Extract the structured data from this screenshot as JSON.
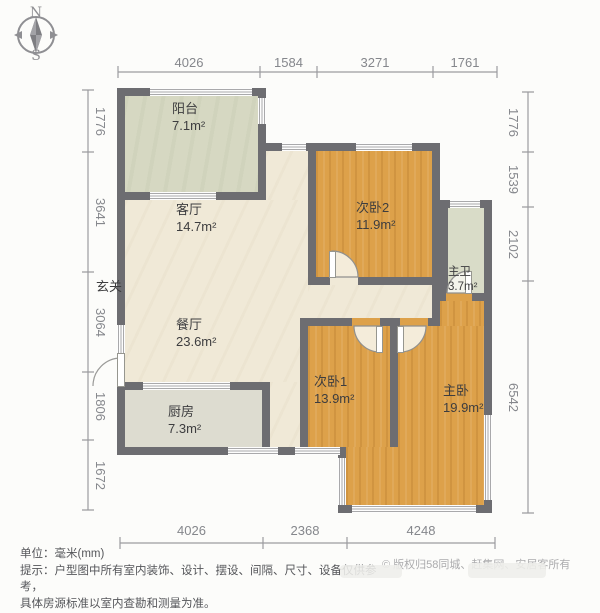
{
  "compass": {
    "north": "N",
    "south": "S"
  },
  "rooms": [
    {
      "id": "balcony",
      "name": "阳台",
      "area": "7.1m²"
    },
    {
      "id": "living",
      "name": "客厅",
      "area": "14.7m²"
    },
    {
      "id": "dining",
      "name": "餐厅",
      "area": "23.6m²"
    },
    {
      "id": "kitchen",
      "name": "厨房",
      "area": "7.3m²"
    },
    {
      "id": "bedroom2",
      "name": "次卧2",
      "area": "11.9m²"
    },
    {
      "id": "bedroom1",
      "name": "次卧1",
      "area": "13.9m²"
    },
    {
      "id": "master",
      "name": "主卧",
      "area": "19.9m²"
    },
    {
      "id": "bathroom",
      "name": "主卫",
      "area": "3.7m²"
    },
    {
      "id": "entry",
      "name": "玄关",
      "area": ""
    }
  ],
  "dimensions": {
    "unit": "mm",
    "top": [
      "4026",
      "1584",
      "3271",
      "1761"
    ],
    "bottom": [
      "4026",
      "2368",
      "4248"
    ],
    "left": [
      "1776",
      "3641",
      "3064",
      "1806",
      "1672"
    ],
    "right": [
      "1776",
      "1539",
      "2102",
      "6542"
    ]
  },
  "footer": {
    "unit_line": "单位：毫米(mm)",
    "tip_line1": "提示：户型图中所有室内装饰、设计、摆设、间隔、尺寸、设备仅供参考，",
    "tip_line2": "具体房源标准以室内查勘和测量为准。",
    "copyright": "© 版权归58同城、赶集网、安居客所有"
  },
  "colors": {
    "wall": "#6d6d71",
    "wood_floor": "#dda14a",
    "living_floor": "#f0e9d7",
    "balcony_floor": "#d6d8c2",
    "kitchen_floor": "#dddcd0",
    "bath_floor": "#d9dcc8",
    "dimension_text": "#85878c"
  }
}
